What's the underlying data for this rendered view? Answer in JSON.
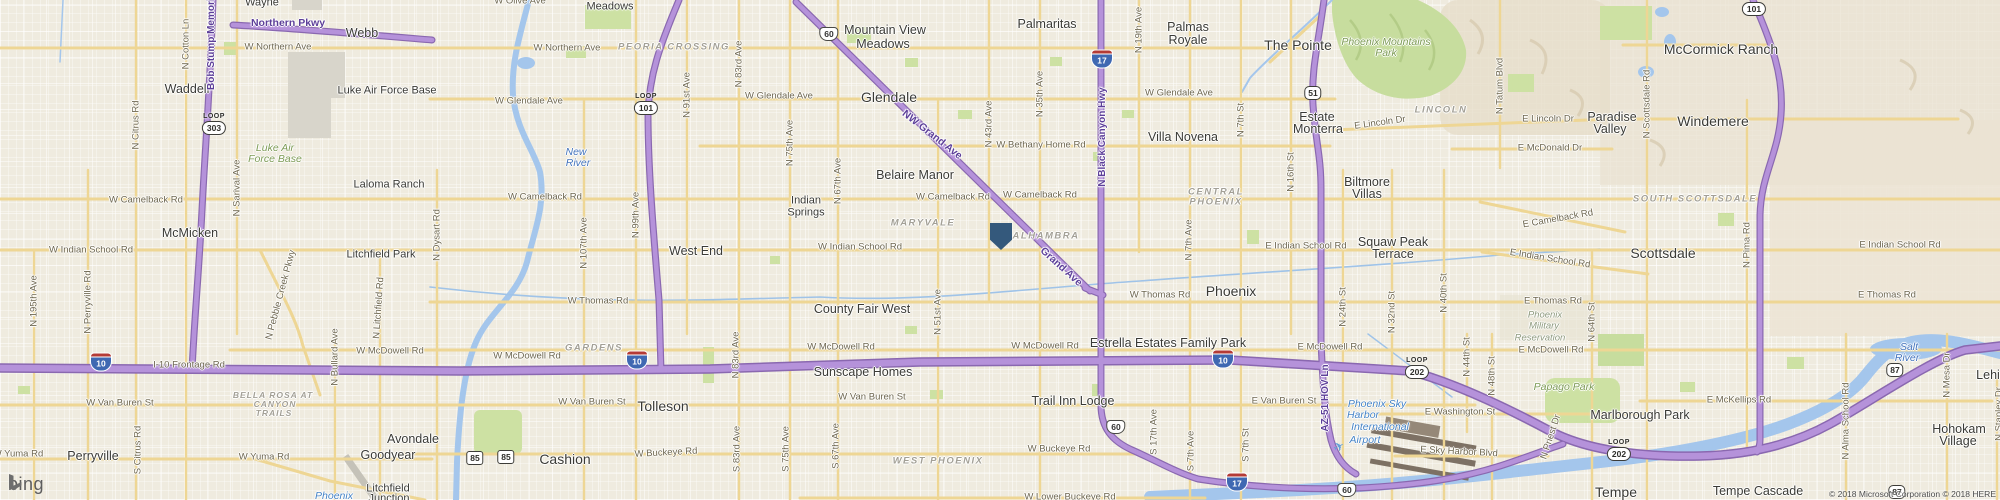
{
  "logo": {
    "text": "bing"
  },
  "attribution": {
    "text": "© 2018 Microsoft Corporation © 2018 HERE"
  },
  "marker": {
    "x": 1001,
    "y": 236,
    "color": "#34597c"
  },
  "plane_icon": {
    "x": 1339,
    "y": 447,
    "glyph": "✈"
  },
  "colors": {
    "highway": "#b592da",
    "arterial": "#eed694",
    "water": "#a4c6ec",
    "park": "#cde1a3",
    "military": "#d8d5cb",
    "marker": "#34597c"
  },
  "shields": [
    {
      "k": "loop",
      "word": "LOOP",
      "n": "303",
      "x": 214,
      "y": 124
    },
    {
      "k": "loop",
      "word": "LOOP",
      "n": "101",
      "x": 646,
      "y": 104
    },
    {
      "k": "loop",
      "word": "LOOP",
      "n": "101",
      "x": 1754,
      "y": 5
    },
    {
      "k": "loop",
      "word": "LOOP",
      "n": "202",
      "x": 1417,
      "y": 368
    },
    {
      "k": "loop",
      "word": "LOOP",
      "n": "202",
      "x": 1619,
      "y": 450
    },
    {
      "k": "i",
      "n": "10",
      "x": 101,
      "y": 362
    },
    {
      "k": "i",
      "n": "10",
      "x": 637,
      "y": 360
    },
    {
      "k": "i",
      "n": "10",
      "x": 1223,
      "y": 359
    },
    {
      "k": "i",
      "n": "17",
      "x": 1102,
      "y": 59
    },
    {
      "k": "i",
      "n": "17",
      "x": 1237,
      "y": 482
    },
    {
      "k": "us",
      "n": "60",
      "x": 829,
      "y": 34
    },
    {
      "k": "us",
      "n": "60",
      "x": 1116,
      "y": 427
    },
    {
      "k": "us",
      "n": "60",
      "x": 1347,
      "y": 490
    },
    {
      "k": "sr",
      "n": "51",
      "x": 1313,
      "y": 93
    },
    {
      "k": "sr85",
      "n": "85",
      "x": 475,
      "y": 458
    },
    {
      "k": "sr85",
      "n": "85",
      "x": 506,
      "y": 457
    },
    {
      "k": "sr",
      "n": "87",
      "x": 1895,
      "y": 370
    },
    {
      "k": "sr",
      "n": "87",
      "x": 1897,
      "y": 492
    }
  ],
  "labels": [
    {
      "t": "Wayne",
      "x": 262,
      "y": 3,
      "c": "pl"
    },
    {
      "t": "Northern Pkwy",
      "x": 288,
      "y": 23,
      "c": "hwy"
    },
    {
      "t": "Webb",
      "x": 362,
      "y": 33,
      "c": "pl lg"
    },
    {
      "t": "W Northern Ave",
      "x": 278,
      "y": 47,
      "c": "rd"
    },
    {
      "t": "W Olive Ave",
      "x": 520,
      "y": 1,
      "c": "rd"
    },
    {
      "t": "Waddell",
      "x": 187,
      "y": 89,
      "c": "pl lg"
    },
    {
      "t": "Luke Air Force Base",
      "x": 387,
      "y": 91,
      "c": "pl"
    },
    {
      "t": "N Cotton Ln",
      "x": 186,
      "y": 44,
      "c": "rd",
      "r": -90
    },
    {
      "t": "Bob Stump Memorial",
      "x": 212,
      "y": 40,
      "c": "hwyv",
      "r": -90
    },
    {
      "t": "N Citrus Rd",
      "x": 136,
      "y": 125,
      "c": "rd",
      "r": -90
    },
    {
      "t": "Luke Air",
      "x": 275,
      "y": 148,
      "c": "park"
    },
    {
      "t": "Force Base",
      "x": 275,
      "y": 159,
      "c": "park"
    },
    {
      "t": "Laloma Ranch",
      "x": 389,
      "y": 185,
      "c": "pl"
    },
    {
      "t": "McMicken",
      "x": 190,
      "y": 233,
      "c": "pl lg"
    },
    {
      "t": "W Camelback Rd",
      "x": 146,
      "y": 200,
      "c": "rd"
    },
    {
      "t": "W Indian School Rd",
      "x": 91,
      "y": 250,
      "c": "rd"
    },
    {
      "t": "N 195th Ave",
      "x": 34,
      "y": 301,
      "c": "rd",
      "r": -90
    },
    {
      "t": "N Perryville Rd",
      "x": 88,
      "y": 302,
      "c": "rd",
      "r": -90
    },
    {
      "t": "N Sarival Ave",
      "x": 237,
      "y": 188,
      "c": "rd",
      "r": -90
    },
    {
      "t": "Litchfield Park",
      "x": 381,
      "y": 255,
      "c": "pl"
    },
    {
      "t": "N Pebble Creek Pkwy",
      "x": 281,
      "y": 295,
      "c": "rd",
      "r": -75
    },
    {
      "t": "N Litchfield Rd",
      "x": 379,
      "y": 308,
      "c": "rd",
      "r": -86
    },
    {
      "t": "Meadows",
      "x": 610,
      "y": 7,
      "c": "pl"
    },
    {
      "t": "W Northern Ave",
      "x": 567,
      "y": 48,
      "c": "rd"
    },
    {
      "t": "PEORIA CROSSING",
      "x": 674,
      "y": 47,
      "c": "dist"
    },
    {
      "t": "W Glendale Ave",
      "x": 529,
      "y": 101,
      "c": "rd"
    },
    {
      "t": "W Glendale Ave",
      "x": 779,
      "y": 96,
      "c": "rd"
    },
    {
      "t": "New",
      "x": 576,
      "y": 152,
      "c": "wat"
    },
    {
      "t": "River",
      "x": 578,
      "y": 163,
      "c": "wat"
    },
    {
      "t": "N 91st Ave",
      "x": 687,
      "y": 95,
      "c": "rd",
      "r": -90
    },
    {
      "t": "N 83rd Ave",
      "x": 739,
      "y": 64,
      "c": "rd",
      "r": -90
    },
    {
      "t": "N 75th Ave",
      "x": 790,
      "y": 143,
      "c": "rd",
      "r": -90
    },
    {
      "t": "N Dysart Rd",
      "x": 437,
      "y": 235,
      "c": "rd",
      "r": -90
    },
    {
      "t": "W Camelback Rd",
      "x": 545,
      "y": 197,
      "c": "rd"
    },
    {
      "t": "N 107th Ave",
      "x": 584,
      "y": 243,
      "c": "rd",
      "r": -90
    },
    {
      "t": "N 99th Ave",
      "x": 636,
      "y": 215,
      "c": "rd",
      "r": -90
    },
    {
      "t": "West End",
      "x": 696,
      "y": 251,
      "c": "pl lg"
    },
    {
      "t": "W Thomas Rd",
      "x": 598,
      "y": 301,
      "c": "rd"
    },
    {
      "t": "Indian",
      "x": 806,
      "y": 201,
      "c": "pl"
    },
    {
      "t": "Springs",
      "x": 806,
      "y": 213,
      "c": "pl"
    },
    {
      "t": "Mountain View",
      "x": 885,
      "y": 30,
      "c": "pl lg"
    },
    {
      "t": "Meadows",
      "x": 883,
      "y": 44,
      "c": "pl lg"
    },
    {
      "t": "Glendale",
      "x": 889,
      "y": 97,
      "c": "pl xl"
    },
    {
      "t": "Palmaritas",
      "x": 1047,
      "y": 24,
      "c": "pl lg"
    },
    {
      "t": "NW Grand Ave",
      "x": 932,
      "y": 135,
      "c": "hwy",
      "r": 38
    },
    {
      "t": "N 43rd Ave",
      "x": 989,
      "y": 124,
      "c": "rd",
      "r": -90
    },
    {
      "t": "N 35th Ave",
      "x": 1040,
      "y": 94,
      "c": "rd",
      "r": -90
    },
    {
      "t": "W Bethany Home Rd",
      "x": 1041,
      "y": 145,
      "c": "rd"
    },
    {
      "t": "N Black Canyon Hwy",
      "x": 1103,
      "y": 137,
      "c": "hwyv",
      "r": -90
    },
    {
      "t": "N 19th Ave",
      "x": 1139,
      "y": 30,
      "c": "rd",
      "r": -90
    },
    {
      "t": "Palmas",
      "x": 1188,
      "y": 27,
      "c": "pl lg"
    },
    {
      "t": "Royale",
      "x": 1188,
      "y": 40,
      "c": "pl lg"
    },
    {
      "t": "W Glendale Ave",
      "x": 1179,
      "y": 93,
      "c": "rd"
    },
    {
      "t": "Villa Novena",
      "x": 1183,
      "y": 137,
      "c": "pl lg"
    },
    {
      "t": "N 7th St",
      "x": 1241,
      "y": 120,
      "c": "rd",
      "r": -90
    },
    {
      "t": "Belaire Manor",
      "x": 915,
      "y": 175,
      "c": "pl lg"
    },
    {
      "t": "N 67th Ave",
      "x": 838,
      "y": 181,
      "c": "rd",
      "r": -90
    },
    {
      "t": "W Camelback Rd",
      "x": 953,
      "y": 197,
      "c": "rd"
    },
    {
      "t": "W Camelback Rd",
      "x": 1040,
      "y": 195,
      "c": "rd"
    },
    {
      "t": "MARYVALE",
      "x": 923,
      "y": 223,
      "c": "dist"
    },
    {
      "t": "ALHAMBRA",
      "x": 1046,
      "y": 236,
      "c": "dist"
    },
    {
      "t": "W Indian School Rd",
      "x": 860,
      "y": 247,
      "c": "rd"
    },
    {
      "t": "Grand Ave",
      "x": 1061,
      "y": 267,
      "c": "hwy",
      "r": 42
    },
    {
      "t": "N 7th Ave",
      "x": 1189,
      "y": 240,
      "c": "rd",
      "r": -90
    },
    {
      "t": "W Thomas Rd",
      "x": 1160,
      "y": 295,
      "c": "rd"
    },
    {
      "t": "County Fair West",
      "x": 862,
      "y": 309,
      "c": "pl lg"
    },
    {
      "t": "N 51st Ave",
      "x": 938,
      "y": 312,
      "c": "rd",
      "r": -90
    },
    {
      "t": "CENTRAL",
      "x": 1216,
      "y": 192,
      "c": "dist"
    },
    {
      "t": "PHOENIX",
      "x": 1216,
      "y": 202,
      "c": "dist"
    },
    {
      "t": "N 16th St",
      "x": 1291,
      "y": 172,
      "c": "rd",
      "r": -90
    },
    {
      "t": "Biltmore",
      "x": 1367,
      "y": 182,
      "c": "pl lg"
    },
    {
      "t": "Villas",
      "x": 1367,
      "y": 194,
      "c": "pl lg"
    },
    {
      "t": "E Camelback Rd",
      "x": 1558,
      "y": 219,
      "c": "rd",
      "r": -10
    },
    {
      "t": "E Indian School Rd",
      "x": 1306,
      "y": 246,
      "c": "rd"
    },
    {
      "t": "Squaw Peak",
      "x": 1393,
      "y": 242,
      "c": "pl lg"
    },
    {
      "t": "Terrace",
      "x": 1393,
      "y": 254,
      "c": "pl lg"
    },
    {
      "t": "E Indian School Rd",
      "x": 1550,
      "y": 259,
      "c": "rd",
      "r": 9
    },
    {
      "t": "Phoenix",
      "x": 1231,
      "y": 291,
      "c": "pl xl"
    },
    {
      "t": "N 24th St",
      "x": 1343,
      "y": 307,
      "c": "rd",
      "r": -90
    },
    {
      "t": "N 32nd St",
      "x": 1392,
      "y": 312,
      "c": "rd",
      "r": -90
    },
    {
      "t": "N 40th St",
      "x": 1444,
      "y": 293,
      "c": "rd",
      "r": -90
    },
    {
      "t": "E Thomas Rd",
      "x": 1553,
      "y": 301,
      "c": "rd"
    },
    {
      "t": "Phoenix",
      "x": 1545,
      "y": 315,
      "c": "park gr"
    },
    {
      "t": "Military",
      "x": 1544,
      "y": 326,
      "c": "park gr"
    },
    {
      "t": "Reservation",
      "x": 1540,
      "y": 338,
      "c": "park gr"
    },
    {
      "t": "N 64th St",
      "x": 1592,
      "y": 322,
      "c": "rd",
      "r": -90
    },
    {
      "t": "The Pointe",
      "x": 1298,
      "y": 45,
      "c": "pl xl"
    },
    {
      "t": "Phoenix Mountains",
      "x": 1386,
      "y": 42,
      "c": "park"
    },
    {
      "t": "Park",
      "x": 1386,
      "y": 53,
      "c": "park"
    },
    {
      "t": "Estate",
      "x": 1317,
      "y": 117,
      "c": "pl lg"
    },
    {
      "t": "Monterra",
      "x": 1318,
      "y": 129,
      "c": "pl lg"
    },
    {
      "t": "E Lincoln Dr",
      "x": 1380,
      "y": 123,
      "c": "rd",
      "r": -8
    },
    {
      "t": "LINCOLN",
      "x": 1441,
      "y": 110,
      "c": "dist"
    },
    {
      "t": "N Tatum Blvd",
      "x": 1500,
      "y": 86,
      "c": "rd",
      "r": -90
    },
    {
      "t": "E Lincoln Dr",
      "x": 1548,
      "y": 119,
      "c": "rd"
    },
    {
      "t": "E McDonald Dr",
      "x": 1550,
      "y": 148,
      "c": "rd"
    },
    {
      "t": "Paradise",
      "x": 1612,
      "y": 117,
      "c": "pl lg"
    },
    {
      "t": "Valley",
      "x": 1610,
      "y": 129,
      "c": "pl lg"
    },
    {
      "t": "McCormick Ranch",
      "x": 1721,
      "y": 49,
      "c": "pl xl"
    },
    {
      "t": "N Scottsdale Rd",
      "x": 1647,
      "y": 104,
      "c": "rd",
      "r": -90
    },
    {
      "t": "Windemere",
      "x": 1713,
      "y": 121,
      "c": "pl xl"
    },
    {
      "t": "SOUTH SCOTTSDALE",
      "x": 1695,
      "y": 199,
      "c": "dist"
    },
    {
      "t": "Scottsdale",
      "x": 1663,
      "y": 253,
      "c": "pl xl"
    },
    {
      "t": "N Pima Rd",
      "x": 1747,
      "y": 245,
      "c": "rd",
      "r": -90
    },
    {
      "t": "E Indian School Rd",
      "x": 1900,
      "y": 245,
      "c": "rd"
    },
    {
      "t": "E Thomas Rd",
      "x": 1887,
      "y": 295,
      "c": "rd"
    },
    {
      "t": "W McDowell Rd",
      "x": 390,
      "y": 351,
      "c": "rd"
    },
    {
      "t": "W Van Buren St",
      "x": 120,
      "y": 403,
      "c": "rd"
    },
    {
      "t": "BELLA ROSA AT",
      "x": 273,
      "y": 395,
      "c": "dist sm"
    },
    {
      "t": "CANYON",
      "x": 275,
      "y": 404,
      "c": "dist sm"
    },
    {
      "t": "TRAILS",
      "x": 274,
      "y": 413,
      "c": "dist sm"
    },
    {
      "t": "N Bullard Ave",
      "x": 335,
      "y": 357,
      "c": "rd",
      "r": -90
    },
    {
      "t": "I-10 Frontage Rd",
      "x": 189,
      "y": 365,
      "c": "rd"
    },
    {
      "t": "Perryville",
      "x": 93,
      "y": 456,
      "c": "pl lg"
    },
    {
      "t": "S Citrus Rd",
      "x": 138,
      "y": 450,
      "c": "rd",
      "r": -90
    },
    {
      "t": "W Yuma Rd",
      "x": 18,
      "y": 454,
      "c": "rd"
    },
    {
      "t": "W Yuma Rd",
      "x": 264,
      "y": 457,
      "c": "rd"
    },
    {
      "t": "Goodyear",
      "x": 388,
      "y": 455,
      "c": "pl lg"
    },
    {
      "t": "Avondale",
      "x": 413,
      "y": 439,
      "c": "pl lg"
    },
    {
      "t": "Litchfield",
      "x": 388,
      "y": 489,
      "c": "pl"
    },
    {
      "t": "Junction",
      "x": 389,
      "y": 499,
      "c": "pl"
    },
    {
      "t": "Phoenix",
      "x": 334,
      "y": 496,
      "c": "air"
    },
    {
      "t": "GARDENS",
      "x": 594,
      "y": 348,
      "c": "dist"
    },
    {
      "t": "W McDowell Rd",
      "x": 527,
      "y": 356,
      "c": "rd"
    },
    {
      "t": "W Van Buren St",
      "x": 592,
      "y": 402,
      "c": "rd"
    },
    {
      "t": "Tolleson",
      "x": 663,
      "y": 406,
      "c": "pl xl"
    },
    {
      "t": "N 83rd Ave",
      "x": 736,
      "y": 355,
      "c": "rd",
      "r": -90
    },
    {
      "t": "Cashion",
      "x": 565,
      "y": 459,
      "c": "pl xl"
    },
    {
      "t": "W Buckeye Rd",
      "x": 666,
      "y": 453,
      "c": "rd",
      "r": -3
    },
    {
      "t": "S 83rd Ave",
      "x": 737,
      "y": 449,
      "c": "rd",
      "r": -90
    },
    {
      "t": "S 75th Ave",
      "x": 786,
      "y": 449,
      "c": "rd",
      "r": -90
    },
    {
      "t": "S 67th Ave",
      "x": 836,
      "y": 446,
      "c": "rd",
      "r": -90
    },
    {
      "t": "W McDowell Rd",
      "x": 841,
      "y": 347,
      "c": "rd"
    },
    {
      "t": "W McDowell Rd",
      "x": 1045,
      "y": 346,
      "c": "rd"
    },
    {
      "t": "Sunscape Homes",
      "x": 863,
      "y": 372,
      "c": "pl lg"
    },
    {
      "t": "W Van Buren St",
      "x": 872,
      "y": 397,
      "c": "rd"
    },
    {
      "t": "Trail Inn Lodge",
      "x": 1073,
      "y": 401,
      "c": "pl lg"
    },
    {
      "t": "Estrella Estates Family Park",
      "x": 1168,
      "y": 343,
      "c": "pl lg"
    },
    {
      "t": "WEST PHOENIX",
      "x": 938,
      "y": 461,
      "c": "dist"
    },
    {
      "t": "W Buckeye Rd",
      "x": 1059,
      "y": 449,
      "c": "rd"
    },
    {
      "t": "W Lower Buckeye Rd",
      "x": 1070,
      "y": 497,
      "c": "rd"
    },
    {
      "t": "S 17th Ave",
      "x": 1154,
      "y": 432,
      "c": "rd",
      "r": -90
    },
    {
      "t": "S 7th Ave",
      "x": 1191,
      "y": 451,
      "c": "rd",
      "r": -90
    },
    {
      "t": "E McDowell Rd",
      "x": 1330,
      "y": 347,
      "c": "rd"
    },
    {
      "t": "E McDowell Rd",
      "x": 1551,
      "y": 350,
      "c": "rd"
    },
    {
      "t": "N 44th St",
      "x": 1467,
      "y": 357,
      "c": "rd",
      "r": -90
    },
    {
      "t": "N 48th St",
      "x": 1492,
      "y": 376,
      "c": "rd",
      "r": -90
    },
    {
      "t": "Papago Park",
      "x": 1564,
      "y": 387,
      "c": "park"
    },
    {
      "t": "E Van Buren St",
      "x": 1284,
      "y": 401,
      "c": "rd"
    },
    {
      "t": "AZ-51 HOV Ln",
      "x": 1326,
      "y": 398,
      "c": "hwyv",
      "r": -90
    },
    {
      "t": "Phoenix Sky",
      "x": 1377,
      "y": 404,
      "c": "air"
    },
    {
      "t": "Harbor",
      "x": 1363,
      "y": 415,
      "c": "air"
    },
    {
      "t": "International",
      "x": 1380,
      "y": 427,
      "c": "air"
    },
    {
      "t": "Airport",
      "x": 1365,
      "y": 440,
      "c": "air"
    },
    {
      "t": "E Washington St",
      "x": 1460,
      "y": 412,
      "c": "rd"
    },
    {
      "t": "E Sky Harbor Blvd",
      "x": 1459,
      "y": 452,
      "c": "rd",
      "r": 3
    },
    {
      "t": "S 7th St",
      "x": 1246,
      "y": 445,
      "c": "rd",
      "r": -90
    },
    {
      "t": "N Priest Dr",
      "x": 1551,
      "y": 437,
      "c": "rd",
      "r": -72
    },
    {
      "t": "Marlborough Park",
      "x": 1640,
      "y": 415,
      "c": "pl lg"
    },
    {
      "t": "Salt",
      "x": 1909,
      "y": 347,
      "c": "wat"
    },
    {
      "t": "River",
      "x": 1907,
      "y": 358,
      "c": "wat"
    },
    {
      "t": "N Mesa Dr",
      "x": 1947,
      "y": 375,
      "c": "rd",
      "r": -90
    },
    {
      "t": "Lehi",
      "x": 1988,
      "y": 375,
      "c": "pl lg"
    },
    {
      "t": "E McKellips Rd",
      "x": 1739,
      "y": 400,
      "c": "rd"
    },
    {
      "t": "N Alma School Rd",
      "x": 1846,
      "y": 421,
      "c": "rd",
      "r": -90
    },
    {
      "t": "Hohokam",
      "x": 1959,
      "y": 429,
      "c": "pl lg"
    },
    {
      "t": "Village",
      "x": 1958,
      "y": 441,
      "c": "pl lg"
    },
    {
      "t": "N Stapley Dr",
      "x": 1999,
      "y": 414,
      "c": "rd",
      "r": -90
    },
    {
      "t": "Tempe",
      "x": 1616,
      "y": 492,
      "c": "pl xl"
    },
    {
      "t": "Tempe Cascade",
      "x": 1758,
      "y": 491,
      "c": "pl lg"
    }
  ]
}
